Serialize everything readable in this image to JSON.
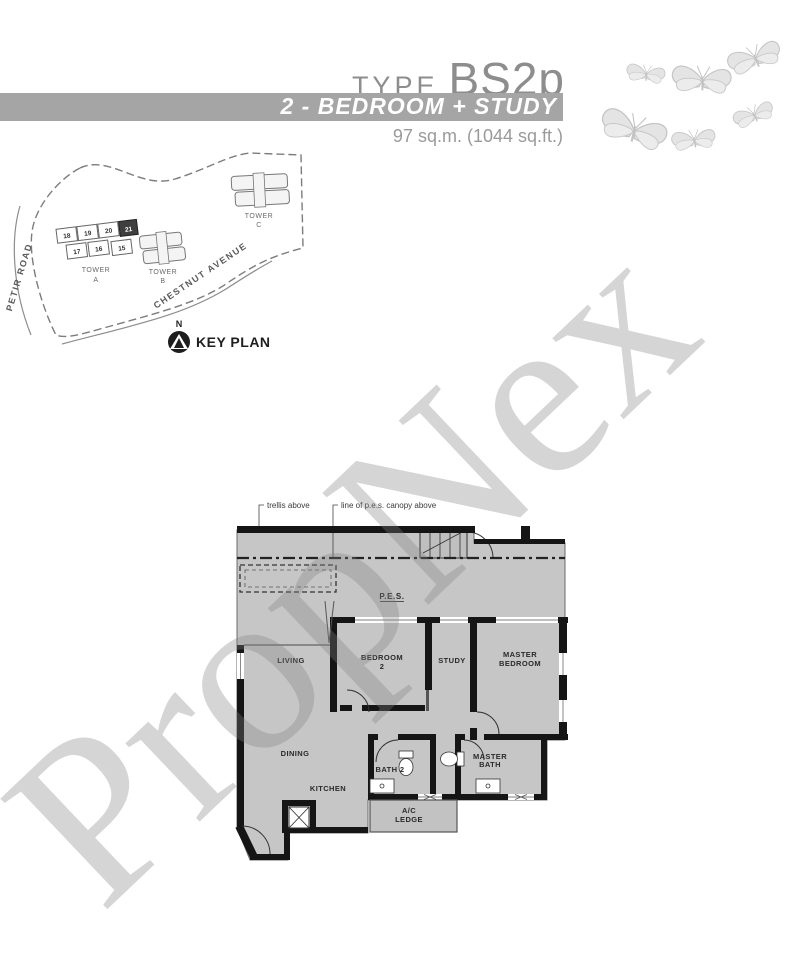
{
  "header": {
    "type_label": "TYPE",
    "type_code": "BS2p",
    "banner": "2 - BEDROOM + STUDY",
    "area": "97 sq.m. (1044 sq.ft.)"
  },
  "key_plan": {
    "title": "KEY PLAN",
    "north_label": "N",
    "roads": {
      "petir": "PETIR ROAD",
      "chestnut": "CHESTNUT AVENUE"
    },
    "towers": {
      "a": {
        "label_l1": "TOWER",
        "label_l2": "A",
        "units_row1": [
          "18",
          "19",
          "20",
          "21"
        ],
        "units_row2": [
          "17",
          "16",
          "15"
        ],
        "highlighted_unit": "21"
      },
      "b": {
        "label_l1": "TOWER",
        "label_l2": "B"
      },
      "c": {
        "label_l1": "TOWER",
        "label_l2": "C"
      }
    }
  },
  "floor_plan": {
    "annotations": {
      "trellis": "trellis above",
      "canopy": "line of p.e.s. canopy above"
    },
    "rooms": {
      "pes": "P.E.S.",
      "living": "LIVING",
      "bedroom2_l1": "BEDROOM",
      "bedroom2_l2": "2",
      "study": "STUDY",
      "master_l1": "MASTER",
      "master_l2": "BEDROOM",
      "dining": "DINING",
      "kitchen": "KITCHEN",
      "bath2": "BATH 2",
      "masterbath_l1": "MASTER",
      "masterbath_l2": "BATH",
      "acledge_l1": "A/C",
      "acledge_l2": "LEDGE"
    }
  },
  "watermark": {
    "text": "PropNex"
  },
  "colors": {
    "banner_bg": "#a5a5a5",
    "plan_fill": "#c6c6c6",
    "wall": "#151515",
    "title_gray": "#8d8d8d",
    "watermark_gray": "rgba(128,128,128,0.33)",
    "butterfly_gray": "#d9d9d9"
  }
}
